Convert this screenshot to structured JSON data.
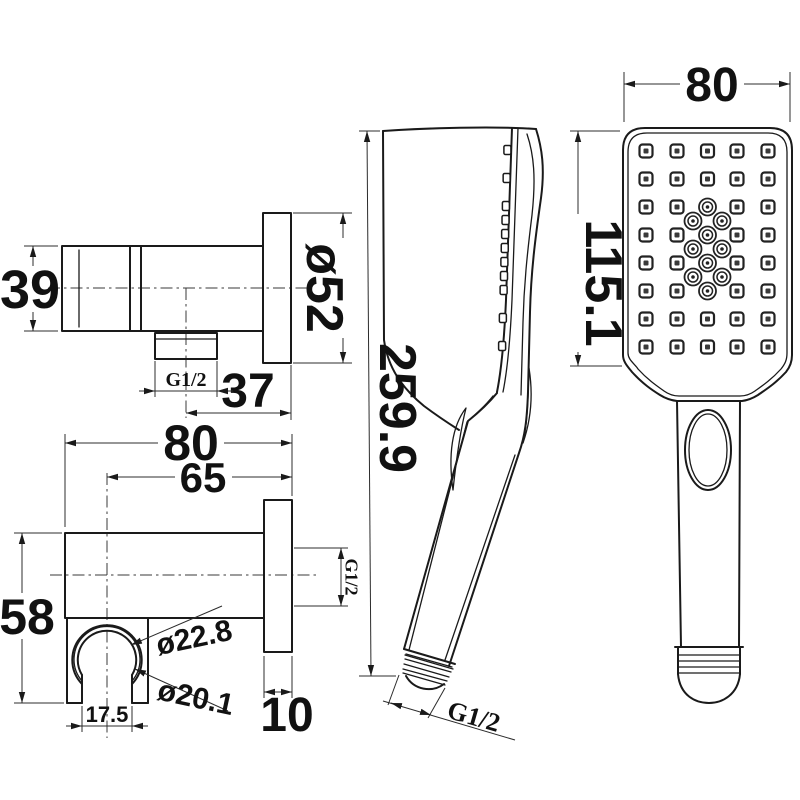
{
  "drawing": {
    "background": "#ffffff",
    "line_color": "#1a1a1a",
    "views": {
      "bracket_side": {
        "title": "wall bracket side view",
        "dims": {
          "body_height": "39",
          "flange_diameter": "ø52",
          "offset_depth": "37",
          "outlet_thread": "G1/2"
        }
      },
      "bracket_front": {
        "title": "wall bracket front view",
        "dims": {
          "overall_width": "80",
          "center_offset": "65",
          "overall_height": "58",
          "holder_outer_diameter": "ø22.8",
          "holder_inner_diameter": "ø20.1",
          "opening_width": "17.5",
          "flange_thickness": "10",
          "inlet_thread": "G1/2"
        }
      },
      "handset_side": {
        "title": "handset side view",
        "dims": {
          "overall_length": "259.9",
          "connector_thread": "G1/2"
        }
      },
      "handset_front": {
        "title": "handset front view",
        "dims": {
          "head_width": "80",
          "head_height": "115.1"
        }
      }
    }
  }
}
